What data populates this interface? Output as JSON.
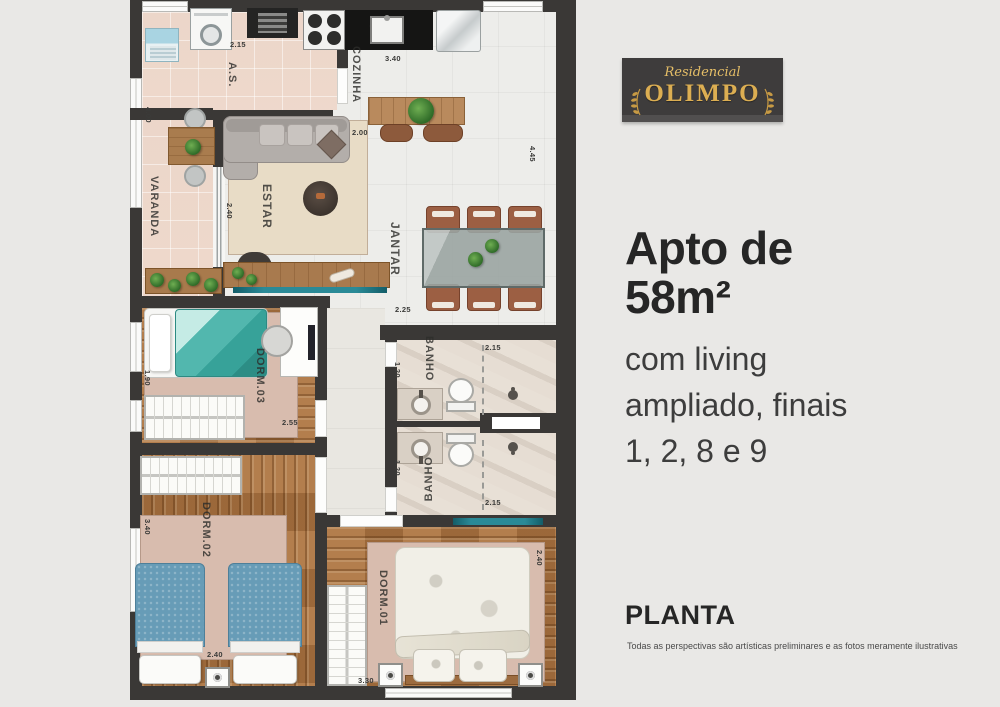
{
  "brand": {
    "script": "Residencial",
    "name": "OLIMPO"
  },
  "headline": {
    "line1": "Apto de",
    "line2": "58m²"
  },
  "subheadline": {
    "line1": "com living",
    "line2": "ampliado, finais",
    "line3": "1, 2, 8 e 9"
  },
  "section": {
    "title": "PLANTA",
    "disclaimer": "Todas as perspectivas são artísticas preliminares e as fotos meramente ilustrativas"
  },
  "plan": {
    "rooms": {
      "varanda": {
        "label": "VARANDA",
        "dim_h": "4.00"
      },
      "area_servico": {
        "label": "A.S.",
        "dim_w": "2.15"
      },
      "cozinha": {
        "label": "COZINHA",
        "dim_w": "3.40",
        "dim_h": "4.45"
      },
      "estar": {
        "label": "ESTAR",
        "dim_top": "2.00",
        "dim_left": "2.40"
      },
      "jantar": {
        "label": "JANTAR",
        "dim_w": "2.25"
      },
      "dorm3": {
        "label": "DORM.03",
        "dim_h": "1.90",
        "dim_w": "2.55"
      },
      "banho_sup": {
        "label": "BANHO",
        "dim_w": "2.15",
        "dim_h": "1.20"
      },
      "banho_inf": {
        "label": "BANHO",
        "dim_w": "2.15",
        "dim_h": "1.20"
      },
      "dorm2": {
        "label": "DORM.02",
        "dim_h": "3.40",
        "dim_w": "2.40"
      },
      "dorm1": {
        "label": "DORM.01",
        "dim_w": "3.30",
        "dim_h": "2.40"
      }
    }
  }
}
